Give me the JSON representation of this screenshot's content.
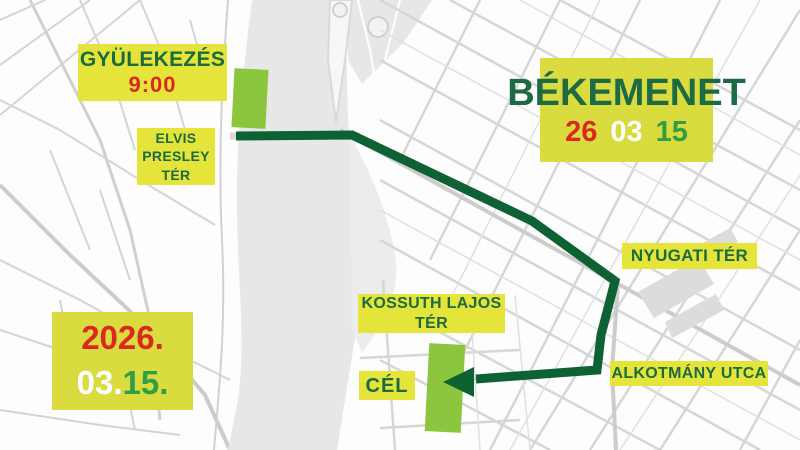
{
  "header": {
    "title": "BÉKEMENET",
    "date_parts": [
      "26",
      "03",
      "15"
    ]
  },
  "date_box": {
    "year": "2026.",
    "month": "03.",
    "day": "15."
  },
  "labels": {
    "gathering_title": "GYÜLEKEZÉS",
    "gathering_time": "9:00",
    "elvis_lines": [
      "ELVIS",
      "PRESLEY",
      "TÉR"
    ],
    "nyugati": "NYUGATI TÉR",
    "kossuth_lines": [
      "KOSSUTH LAJOS",
      "TÉR"
    ],
    "finish": "CÉL",
    "alkotmany": "ALKOTMÁNY UTCA"
  },
  "colors": {
    "label_yellow": "#e4e43a",
    "panel_yellow": "#d9db3e",
    "dark_green_text": "#1c6b3d",
    "route_green": "#0e6132",
    "marker_green": "#8cc63e",
    "red": "#da291f",
    "white": "#ffffff",
    "bright_green": "#2f9e45",
    "river_gray": "#e7e7e7",
    "street_gray": "#d6d6d6"
  }
}
